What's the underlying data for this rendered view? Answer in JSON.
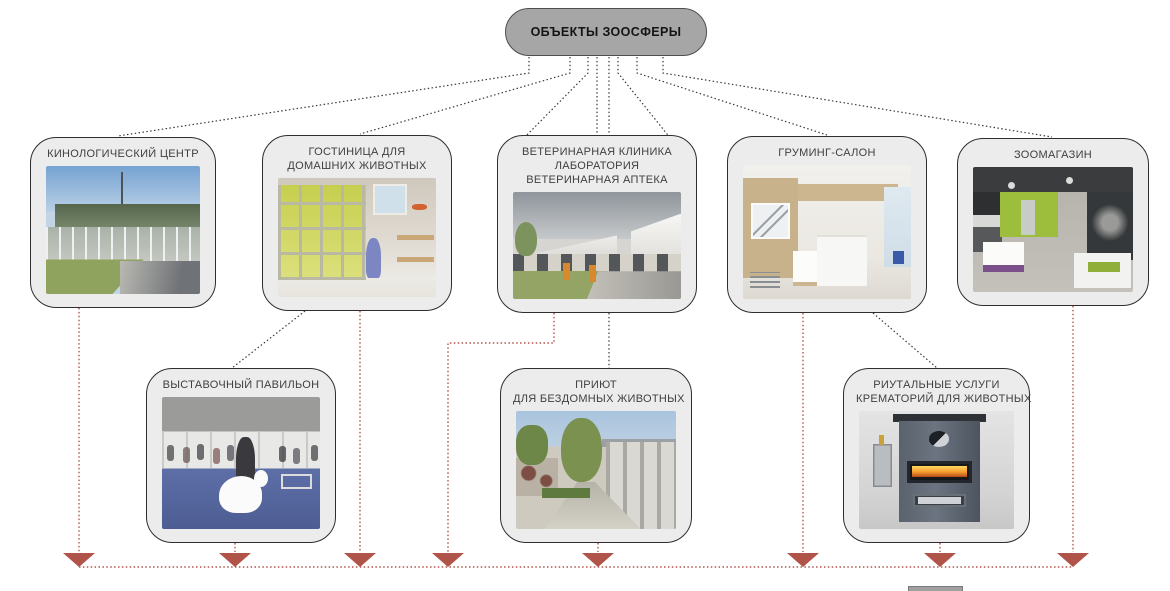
{
  "root": {
    "label": "ОБЪЕКТЫ ЗООСФЕРЫ"
  },
  "nodes": [
    {
      "id": "cynology-center",
      "lines": [
        "КИНОЛОГИЧЕСКИЙ ЦЕНТР"
      ],
      "photo": "dog-training-center-photo"
    },
    {
      "id": "pet-hotel",
      "lines": [
        "ГОСТИНИЦА ДЛЯ",
        "ДОМАШНИХ ЖИВОТНЫХ"
      ],
      "photo": "pet-hotel-interior-photo"
    },
    {
      "id": "vet-clinic",
      "lines": [
        "ВЕТЕРИНАРНАЯ КЛИНИКА",
        "ЛАБОРАТОРИЯ",
        "ВЕТЕРИНАРНАЯ АПТЕКА"
      ],
      "photo": "vet-clinic-building-photo"
    },
    {
      "id": "grooming-salon",
      "lines": [
        "ГРУМИНГ-САЛОН"
      ],
      "photo": "grooming-salon-interior-photo"
    },
    {
      "id": "pet-shop",
      "lines": [
        "ЗООМАГАЗИН"
      ],
      "photo": "pet-shop-interior-photo"
    },
    {
      "id": "exhibition-pavilion",
      "lines": [
        "ВЫСТАВОЧНЫЙ ПАВИЛЬОН"
      ],
      "photo": "dog-show-photo"
    },
    {
      "id": "animal-shelter",
      "lines": [
        "ПРИЮТ",
        "ДЛЯ БЕЗДОМНЫХ ЖИВОТНЫХ"
      ],
      "photo": "animal-shelter-yard-photo"
    },
    {
      "id": "pet-crematorium",
      "lines": [
        "РИУТАЛЬНЫЕ УСЛУГИ",
        "КРЕМАТОРИЙ ДЛЯ ЖИВОТНЫХ"
      ],
      "photo": "pet-crematorium-furnace-photo"
    }
  ],
  "colors": {
    "root_fill": "#a6a6a6",
    "node_fill": "#ececec",
    "connector": "#3a3a3a",
    "flow_accent": "#b0544a"
  }
}
